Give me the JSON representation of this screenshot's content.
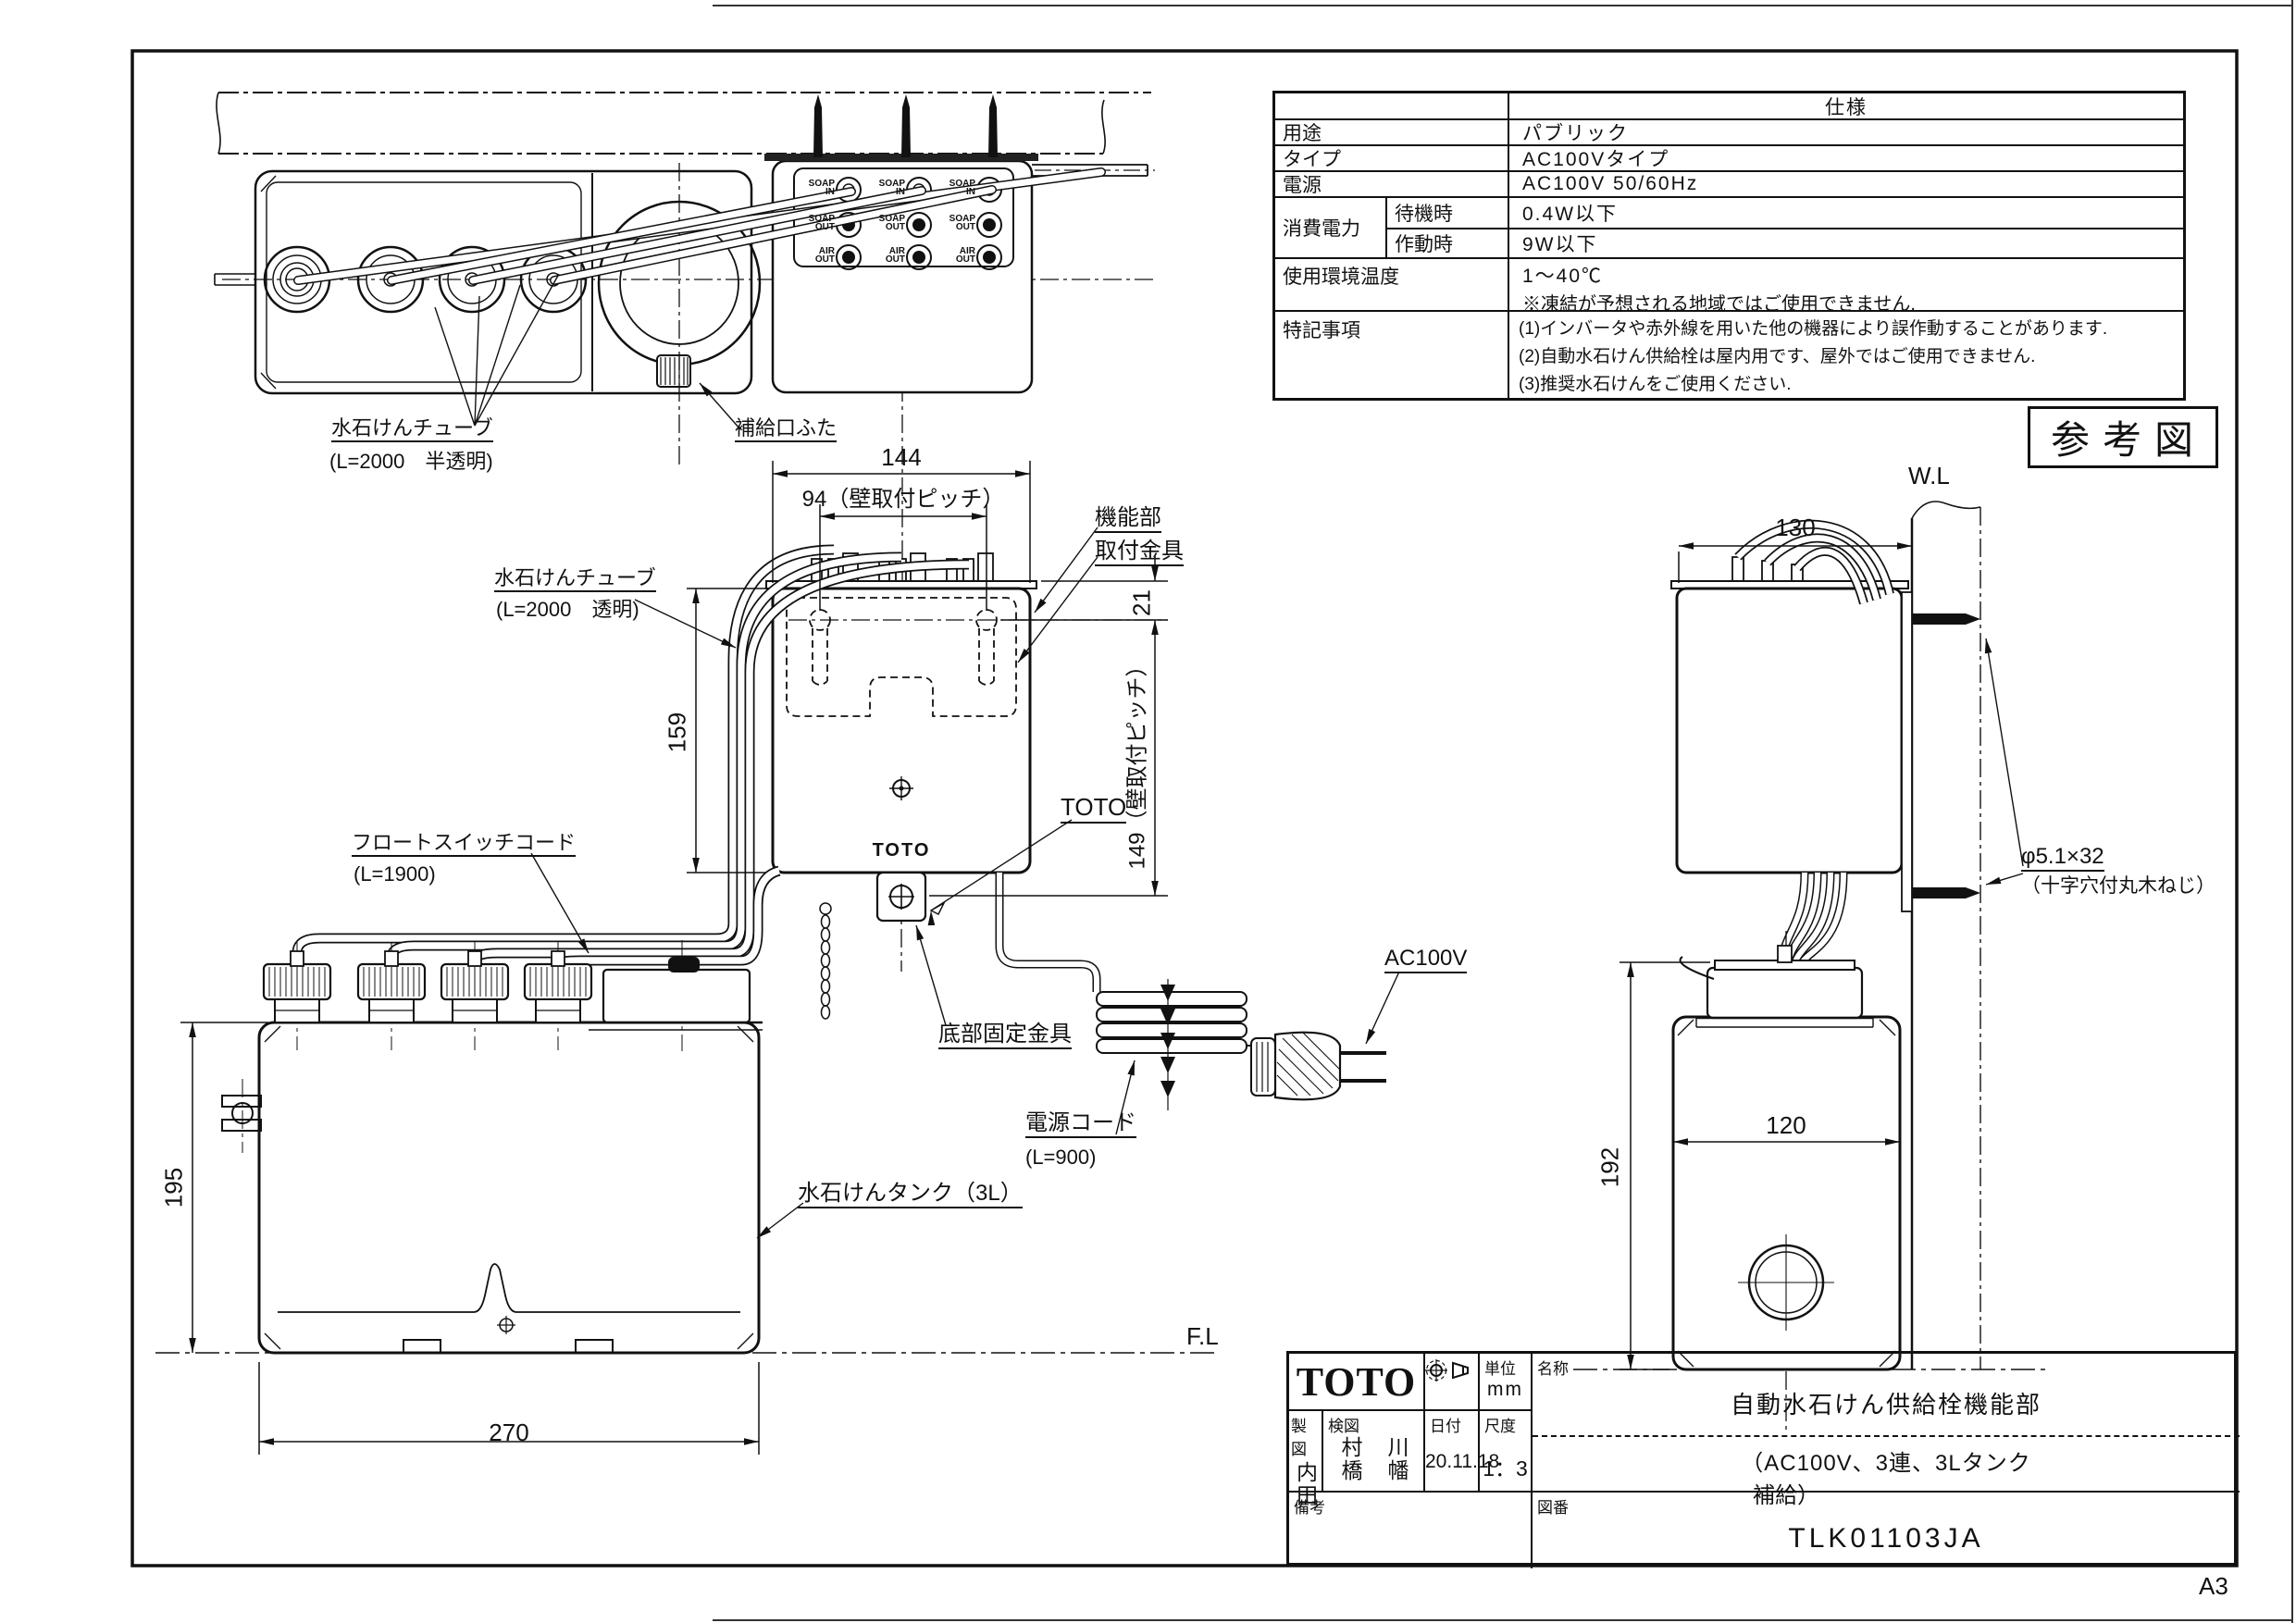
{
  "page": {
    "size_label": "A3"
  },
  "stamp": {
    "text": "参考図"
  },
  "spec_table": {
    "header": "仕様",
    "usage_label": "用途",
    "usage_value": "パブリック",
    "type_label": "タイプ",
    "type_value": "AC100Vタイプ",
    "power_label": "電源",
    "power_value": "AC100V 50/60Hz",
    "consumption_label": "消費電力",
    "standby_label": "待機時",
    "standby_value": "0.4W以下",
    "active_label": "作動時",
    "active_value": "9W以下",
    "temp_label": "使用環境温度",
    "temp_value": "1～40℃",
    "temp_note": "※凍結が予想される地域ではご使用できません.",
    "notes_label": "特記事項",
    "note1": "(1)インバータや赤外線を用いた他の機器により誤作動することがあります.",
    "note2": "(2)自動水石けん供給栓は屋内用です、屋外ではご使用できません.",
    "note3": "(3)推奨水石けんをご使用ください."
  },
  "top_view": {
    "tube_label": "水石けんチューブ",
    "tube_sub": "(L=2000　半透明)",
    "refill_label": "補給口ふた",
    "port_soap_in": "SOAP\nIN",
    "port_soap_out": "SOAP\nOUT",
    "port_air_out": "AIR\nOUT"
  },
  "front_view": {
    "dim_144": "144",
    "dim_94": "94（壁取付ピッチ）",
    "dim_21": "21",
    "dim_159": "159",
    "dim_149": "149（壁取付ピッチ）",
    "dim_195": "195",
    "dim_270": "270",
    "unit_label": "機能部",
    "bracket_label": "取付金具",
    "logo_label": "TOTO",
    "logo_on_unit": "TOTO",
    "tube_label": "水石けんチューブ",
    "tube_sub": "(L=2000　透明)",
    "float_label": "フロートスイッチコード",
    "float_sub": "(L=1900)",
    "bottom_bracket_label": "底部固定金具",
    "cord_label": "電源コード",
    "cord_sub": "(L=900)",
    "plug_label": "AC100V",
    "tank_label": "水石けんタンク（3L）",
    "floor_line": "F.L"
  },
  "side_view": {
    "wall_line": "W.L",
    "dim_130": "130",
    "dim_192": "192",
    "dim_120": "120",
    "screw_label": "φ5.1×32",
    "screw_sub": "（十字穴付丸木ねじ）"
  },
  "title_block": {
    "logo": "TOTO",
    "unit_label": "単位",
    "unit_value": "mm",
    "name_label": "名称",
    "name_value": "自動水石けん供給栓機能部",
    "name_sub1": "（AC100V、3連、3Lタンク",
    "name_sub2": "補給）",
    "drafter_label": "製図",
    "drafter": "内田",
    "checker_label": "検図",
    "checker1": "村橋",
    "checker2": "川幡",
    "date_label": "日付",
    "date_value": "20.11.18",
    "scale_label": "尺度",
    "scale_value": "1：3",
    "remarks_label": "備考",
    "number_label": "図番",
    "number_value": "TLK01103JA"
  }
}
